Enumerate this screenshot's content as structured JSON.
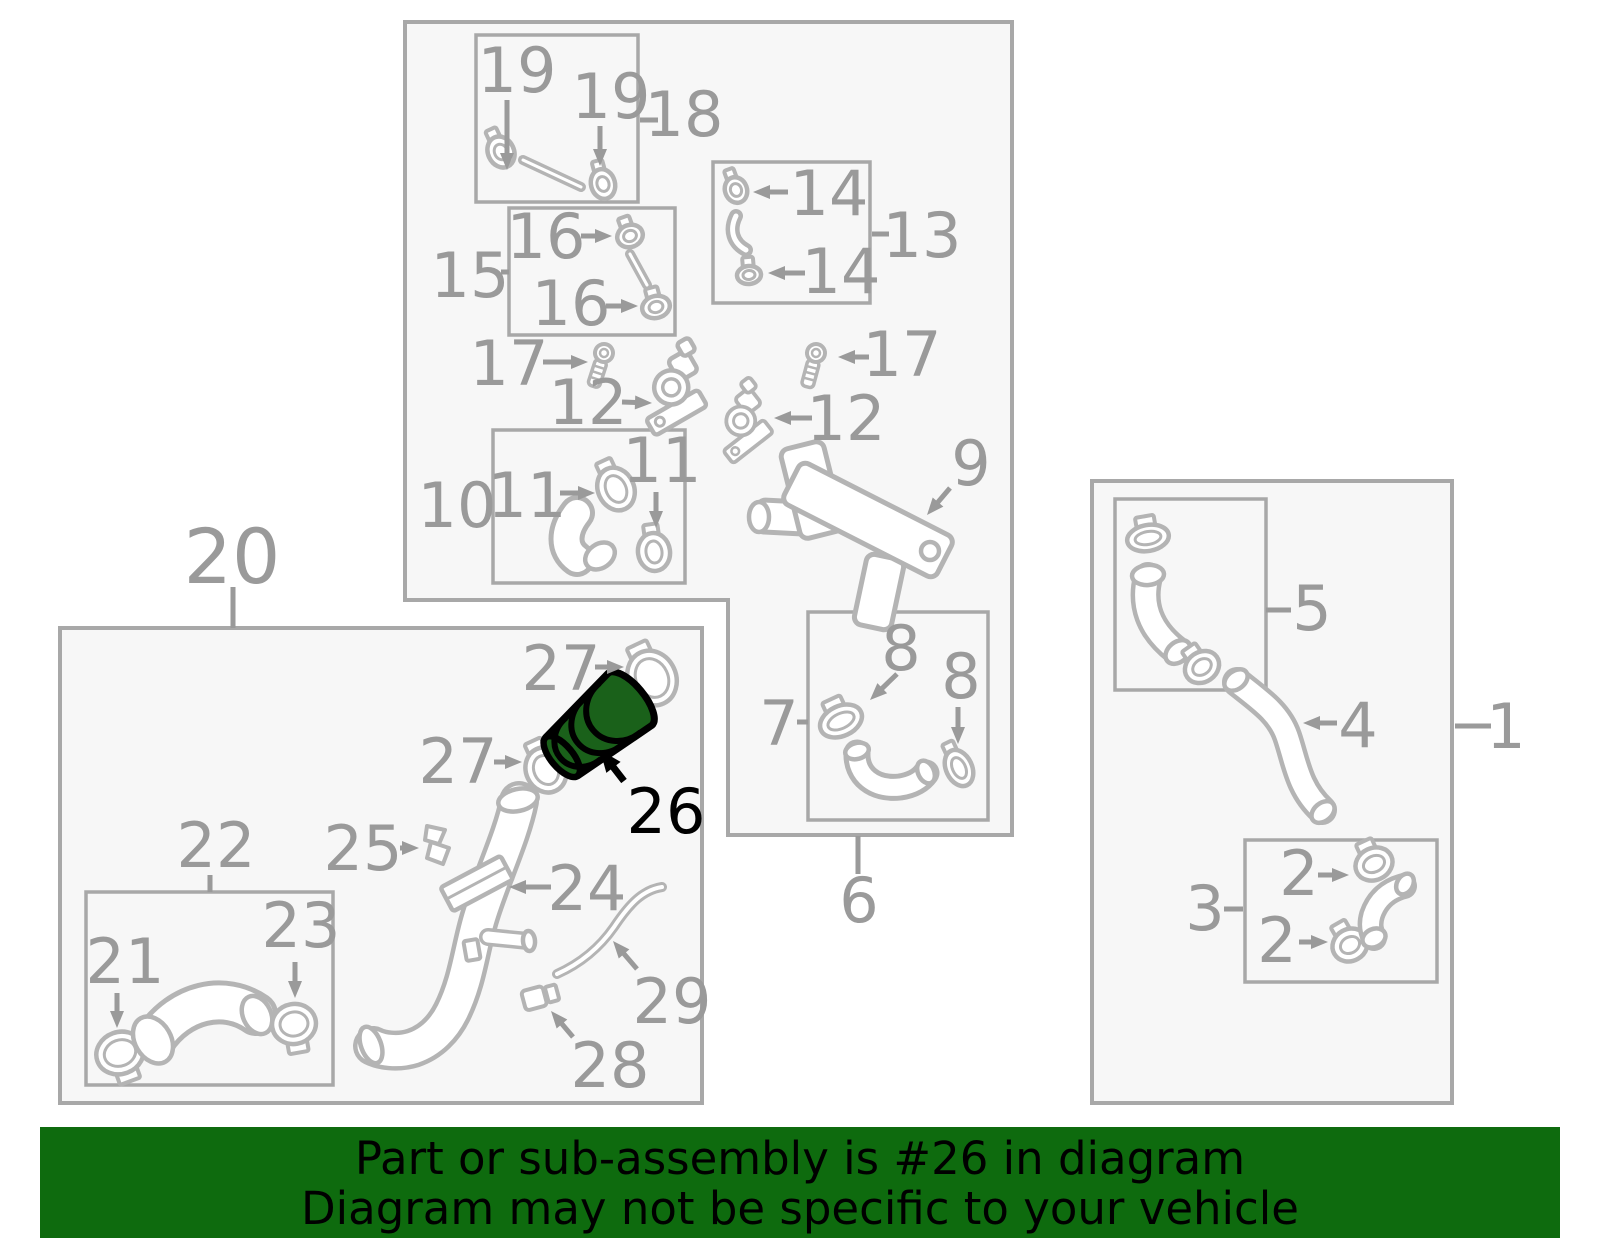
{
  "banner": {
    "line1": "Part or sub-assembly is #26 in diagram",
    "line2": "Diagram may not be specific to your vehicle",
    "bg": "#0e6b0e",
    "text_color": "#000000"
  },
  "highlight": {
    "part_number": "26",
    "fill": "#1a611a",
    "outline": "#000000"
  },
  "colors": {
    "box_stroke": "#a8a8a8",
    "box_fill": "#f7f7f7",
    "label": "#9a9a9a",
    "part_stroke": "#b4b4b4",
    "part_fill": "#ffffff",
    "background": "#ffffff"
  },
  "boxes": [
    {
      "name": "assembly-box-top",
      "poly": "405,22 1012,22 1012,835 728,835 728,600 405,600",
      "sw": 4
    },
    {
      "name": "sub-box-18",
      "x": 476,
      "y": 35,
      "w": 162,
      "h": 167,
      "sw": 3.5
    },
    {
      "name": "sub-box-15",
      "x": 509,
      "y": 208,
      "w": 166,
      "h": 127,
      "sw": 3.5
    },
    {
      "name": "sub-box-13",
      "x": 713,
      "y": 162,
      "w": 157,
      "h": 141,
      "sw": 3.5
    },
    {
      "name": "sub-box-10",
      "x": 493,
      "y": 430,
      "w": 192,
      "h": 153,
      "sw": 3.5
    },
    {
      "name": "sub-box-7",
      "x": 808,
      "y": 612,
      "w": 180,
      "h": 208,
      "sw": 3.5
    },
    {
      "name": "assembly-box-20",
      "x": 60,
      "y": 628,
      "w": 642,
      "h": 475,
      "sw": 4
    },
    {
      "name": "sub-box-22",
      "x": 86,
      "y": 892,
      "w": 247,
      "h": 193,
      "sw": 3.5
    },
    {
      "name": "assembly-box-1",
      "x": 1092,
      "y": 481,
      "w": 360,
      "h": 622,
      "sw": 4
    },
    {
      "name": "sub-box-5",
      "x": 1115,
      "y": 499,
      "w": 151,
      "h": 191,
      "sw": 3.5
    },
    {
      "name": "sub-box-3",
      "x": 1245,
      "y": 840,
      "w": 192,
      "h": 142,
      "sw": 3.5
    }
  ],
  "labels": [
    {
      "id": "19a",
      "text": "19",
      "x": 517,
      "y": 92
    },
    {
      "id": "19b",
      "text": "19",
      "x": 611,
      "y": 118
    },
    {
      "id": "18",
      "text": "18",
      "x": 684,
      "y": 136
    },
    {
      "id": "15",
      "text": "15",
      "x": 470,
      "y": 297
    },
    {
      "id": "16a",
      "text": "16",
      "x": 546,
      "y": 258
    },
    {
      "id": "16b",
      "text": "16",
      "x": 571,
      "y": 325
    },
    {
      "id": "13",
      "text": "13",
      "x": 922,
      "y": 257
    },
    {
      "id": "14a",
      "text": "14",
      "x": 829,
      "y": 215
    },
    {
      "id": "14b",
      "text": "14",
      "x": 841,
      "y": 293
    },
    {
      "id": "17a",
      "text": "17",
      "x": 509,
      "y": 385
    },
    {
      "id": "17b",
      "text": "17",
      "x": 902,
      "y": 376
    },
    {
      "id": "12a",
      "text": "12",
      "x": 588,
      "y": 424
    },
    {
      "id": "12b",
      "text": "12",
      "x": 846,
      "y": 440
    },
    {
      "id": "10",
      "text": "10",
      "x": 457,
      "y": 527
    },
    {
      "id": "11a",
      "text": "11",
      "x": 527,
      "y": 517
    },
    {
      "id": "11b",
      "text": "11",
      "x": 662,
      "y": 482
    },
    {
      "id": "9",
      "text": "9",
      "x": 971,
      "y": 485
    },
    {
      "id": "7",
      "text": "7",
      "x": 779,
      "y": 745
    },
    {
      "id": "8a",
      "text": "8",
      "x": 901,
      "y": 670
    },
    {
      "id": "8b",
      "text": "8",
      "x": 961,
      "y": 698
    },
    {
      "id": "6",
      "text": "6",
      "x": 859,
      "y": 922
    },
    {
      "id": "20",
      "text": "20",
      "x": 232,
      "y": 583,
      "size": 76
    },
    {
      "id": "27a",
      "text": "27",
      "x": 561,
      "y": 690
    },
    {
      "id": "27b",
      "text": "27",
      "x": 458,
      "y": 783
    },
    {
      "id": "26",
      "text": "26",
      "x": 666,
      "y": 833,
      "color": "#000000"
    },
    {
      "id": "25",
      "text": "25",
      "x": 363,
      "y": 870
    },
    {
      "id": "24",
      "text": "24",
      "x": 587,
      "y": 910
    },
    {
      "id": "22",
      "text": "22",
      "x": 216,
      "y": 867
    },
    {
      "id": "21",
      "text": "21",
      "x": 125,
      "y": 983
    },
    {
      "id": "23",
      "text": "23",
      "x": 301,
      "y": 947
    },
    {
      "id": "29",
      "text": "29",
      "x": 672,
      "y": 1023
    },
    {
      "id": "28",
      "text": "28",
      "x": 610,
      "y": 1087
    },
    {
      "id": "5",
      "text": "5",
      "x": 1312,
      "y": 630
    },
    {
      "id": "4",
      "text": "4",
      "x": 1358,
      "y": 747
    },
    {
      "id": "1",
      "text": "1",
      "x": 1506,
      "y": 748
    },
    {
      "id": "3",
      "text": "3",
      "x": 1205,
      "y": 930
    },
    {
      "id": "2a",
      "text": "2",
      "x": 1299,
      "y": 895
    },
    {
      "id": "2b",
      "text": "2",
      "x": 1277,
      "y": 962
    }
  ],
  "connector_lines": [
    {
      "x1": 640,
      "y1": 120,
      "x2": 658,
      "y2": 120
    },
    {
      "x1": 501,
      "y1": 272,
      "x2": 509,
      "y2": 272
    },
    {
      "x1": 872,
      "y1": 234,
      "x2": 889,
      "y2": 234
    },
    {
      "x1": 797,
      "y1": 722,
      "x2": 808,
      "y2": 722
    },
    {
      "x1": 858,
      "y1": 836,
      "x2": 858,
      "y2": 874
    },
    {
      "x1": 233,
      "y1": 587,
      "x2": 233,
      "y2": 628
    },
    {
      "x1": 210,
      "y1": 875,
      "x2": 210,
      "y2": 892
    },
    {
      "x1": 1266,
      "y1": 610,
      "x2": 1291,
      "y2": 610
    },
    {
      "x1": 1455,
      "y1": 726,
      "x2": 1491,
      "y2": 726
    },
    {
      "x1": 1224,
      "y1": 909,
      "x2": 1243,
      "y2": 909
    }
  ],
  "arrows": [
    {
      "x1": 507,
      "y1": 100,
      "x2": 507,
      "y2": 170
    },
    {
      "x1": 600,
      "y1": 126,
      "x2": 600,
      "y2": 166
    },
    {
      "x1": 581,
      "y1": 236,
      "x2": 612,
      "y2": 236
    },
    {
      "x1": 606,
      "y1": 306,
      "x2": 638,
      "y2": 306
    },
    {
      "x1": 788,
      "y1": 192,
      "x2": 753,
      "y2": 192
    },
    {
      "x1": 805,
      "y1": 273,
      "x2": 768,
      "y2": 273
    },
    {
      "x1": 543,
      "y1": 362,
      "x2": 588,
      "y2": 362
    },
    {
      "x1": 869,
      "y1": 357,
      "x2": 838,
      "y2": 357
    },
    {
      "x1": 622,
      "y1": 402,
      "x2": 652,
      "y2": 403
    },
    {
      "x1": 812,
      "y1": 418,
      "x2": 774,
      "y2": 418
    },
    {
      "x1": 560,
      "y1": 493,
      "x2": 595,
      "y2": 493
    },
    {
      "x1": 656,
      "y1": 492,
      "x2": 656,
      "y2": 528
    },
    {
      "x1": 950,
      "y1": 488,
      "x2": 927,
      "y2": 515
    },
    {
      "x1": 897,
      "y1": 674,
      "x2": 870,
      "y2": 700
    },
    {
      "x1": 958,
      "y1": 707,
      "x2": 958,
      "y2": 744
    },
    {
      "x1": 595,
      "y1": 667,
      "x2": 624,
      "y2": 667
    },
    {
      "x1": 494,
      "y1": 762,
      "x2": 522,
      "y2": 762
    },
    {
      "x1": 117,
      "y1": 993,
      "x2": 117,
      "y2": 1028
    },
    {
      "x1": 295,
      "y1": 962,
      "x2": 295,
      "y2": 998
    },
    {
      "x1": 400,
      "y1": 848,
      "x2": 419,
      "y2": 848
    },
    {
      "x1": 551,
      "y1": 887,
      "x2": 509,
      "y2": 887
    },
    {
      "x1": 637,
      "y1": 969,
      "x2": 613,
      "y2": 941
    },
    {
      "x1": 573,
      "y1": 1037,
      "x2": 551,
      "y2": 1011
    },
    {
      "x1": 1318,
      "y1": 875,
      "x2": 1349,
      "y2": 875
    },
    {
      "x1": 1299,
      "y1": 942,
      "x2": 1328,
      "y2": 942
    },
    {
      "x1": 1337,
      "y1": 723,
      "x2": 1303,
      "y2": 723
    }
  ],
  "highlight_arrow": {
    "x1": 624,
    "y1": 781,
    "x2": 600,
    "y2": 750
  },
  "parts": [
    {
      "id": "rod-18",
      "name": "tube-18-icon"
    },
    {
      "id": "clamp-19a",
      "name": "hose-clamp-19-icon"
    },
    {
      "id": "clamp-19b",
      "name": "hose-clamp-19-icon"
    },
    {
      "id": "rod-15",
      "name": "tube-15-icon"
    },
    {
      "id": "clamp-16a",
      "name": "hose-clamp-16-icon"
    },
    {
      "id": "clamp-16b",
      "name": "hose-clamp-16-icon"
    },
    {
      "id": "clamp-14a",
      "name": "hose-clamp-14-icon"
    },
    {
      "id": "hose-13",
      "name": "hose-13-icon"
    },
    {
      "id": "clamp-14b",
      "name": "hose-clamp-14-icon"
    },
    {
      "id": "screw-17a",
      "name": "screw-17-icon"
    },
    {
      "id": "screw-17b",
      "name": "screw-17-icon"
    },
    {
      "id": "sensor-12a",
      "name": "valve-12-icon"
    },
    {
      "id": "sensor-12b",
      "name": "valve-12-icon"
    },
    {
      "id": "hose-10",
      "name": "hose-11-icon"
    },
    {
      "id": "clamp-11a",
      "name": "hose-clamp-11-icon"
    },
    {
      "id": "clamp-11b",
      "name": "hose-clamp-11-icon"
    },
    {
      "id": "bracket-9",
      "name": "bracket-9-icon"
    },
    {
      "id": "clamp-8a",
      "name": "hose-clamp-8-icon"
    },
    {
      "id": "clamp-8b",
      "name": "hose-clamp-8-icon"
    },
    {
      "id": "hose-7",
      "name": "hose-7-icon"
    },
    {
      "id": "clamp-27a",
      "name": "hose-clamp-27-icon"
    },
    {
      "id": "clamp-27b",
      "name": "hose-clamp-27-icon"
    },
    {
      "id": "pipe-24",
      "name": "filler-pipe-24-icon"
    },
    {
      "id": "clip-25",
      "name": "clip-25-icon"
    },
    {
      "id": "hose-29",
      "name": "hose-29-icon"
    },
    {
      "id": "clip-28",
      "name": "clip-28-icon"
    },
    {
      "id": "clamp-21",
      "name": "hose-clamp-21-icon"
    },
    {
      "id": "hose-22",
      "name": "hose-22-icon"
    },
    {
      "id": "clamp-23",
      "name": "hose-clamp-23-icon"
    },
    {
      "id": "clamp-5a",
      "name": "hose-clamp-5-icon"
    },
    {
      "id": "hose-5",
      "name": "hose-5-icon"
    },
    {
      "id": "clamp-5b",
      "name": "hose-clamp-5-icon"
    },
    {
      "id": "hose-4",
      "name": "hose-4-icon"
    },
    {
      "id": "clamp-2a",
      "name": "hose-clamp-2-icon"
    },
    {
      "id": "clamp-2b",
      "name": "hose-clamp-2-icon"
    },
    {
      "id": "hose-3",
      "name": "hose-3-icon"
    },
    {
      "id": "part-26",
      "name": "highlighted-hose-connector-26"
    }
  ]
}
